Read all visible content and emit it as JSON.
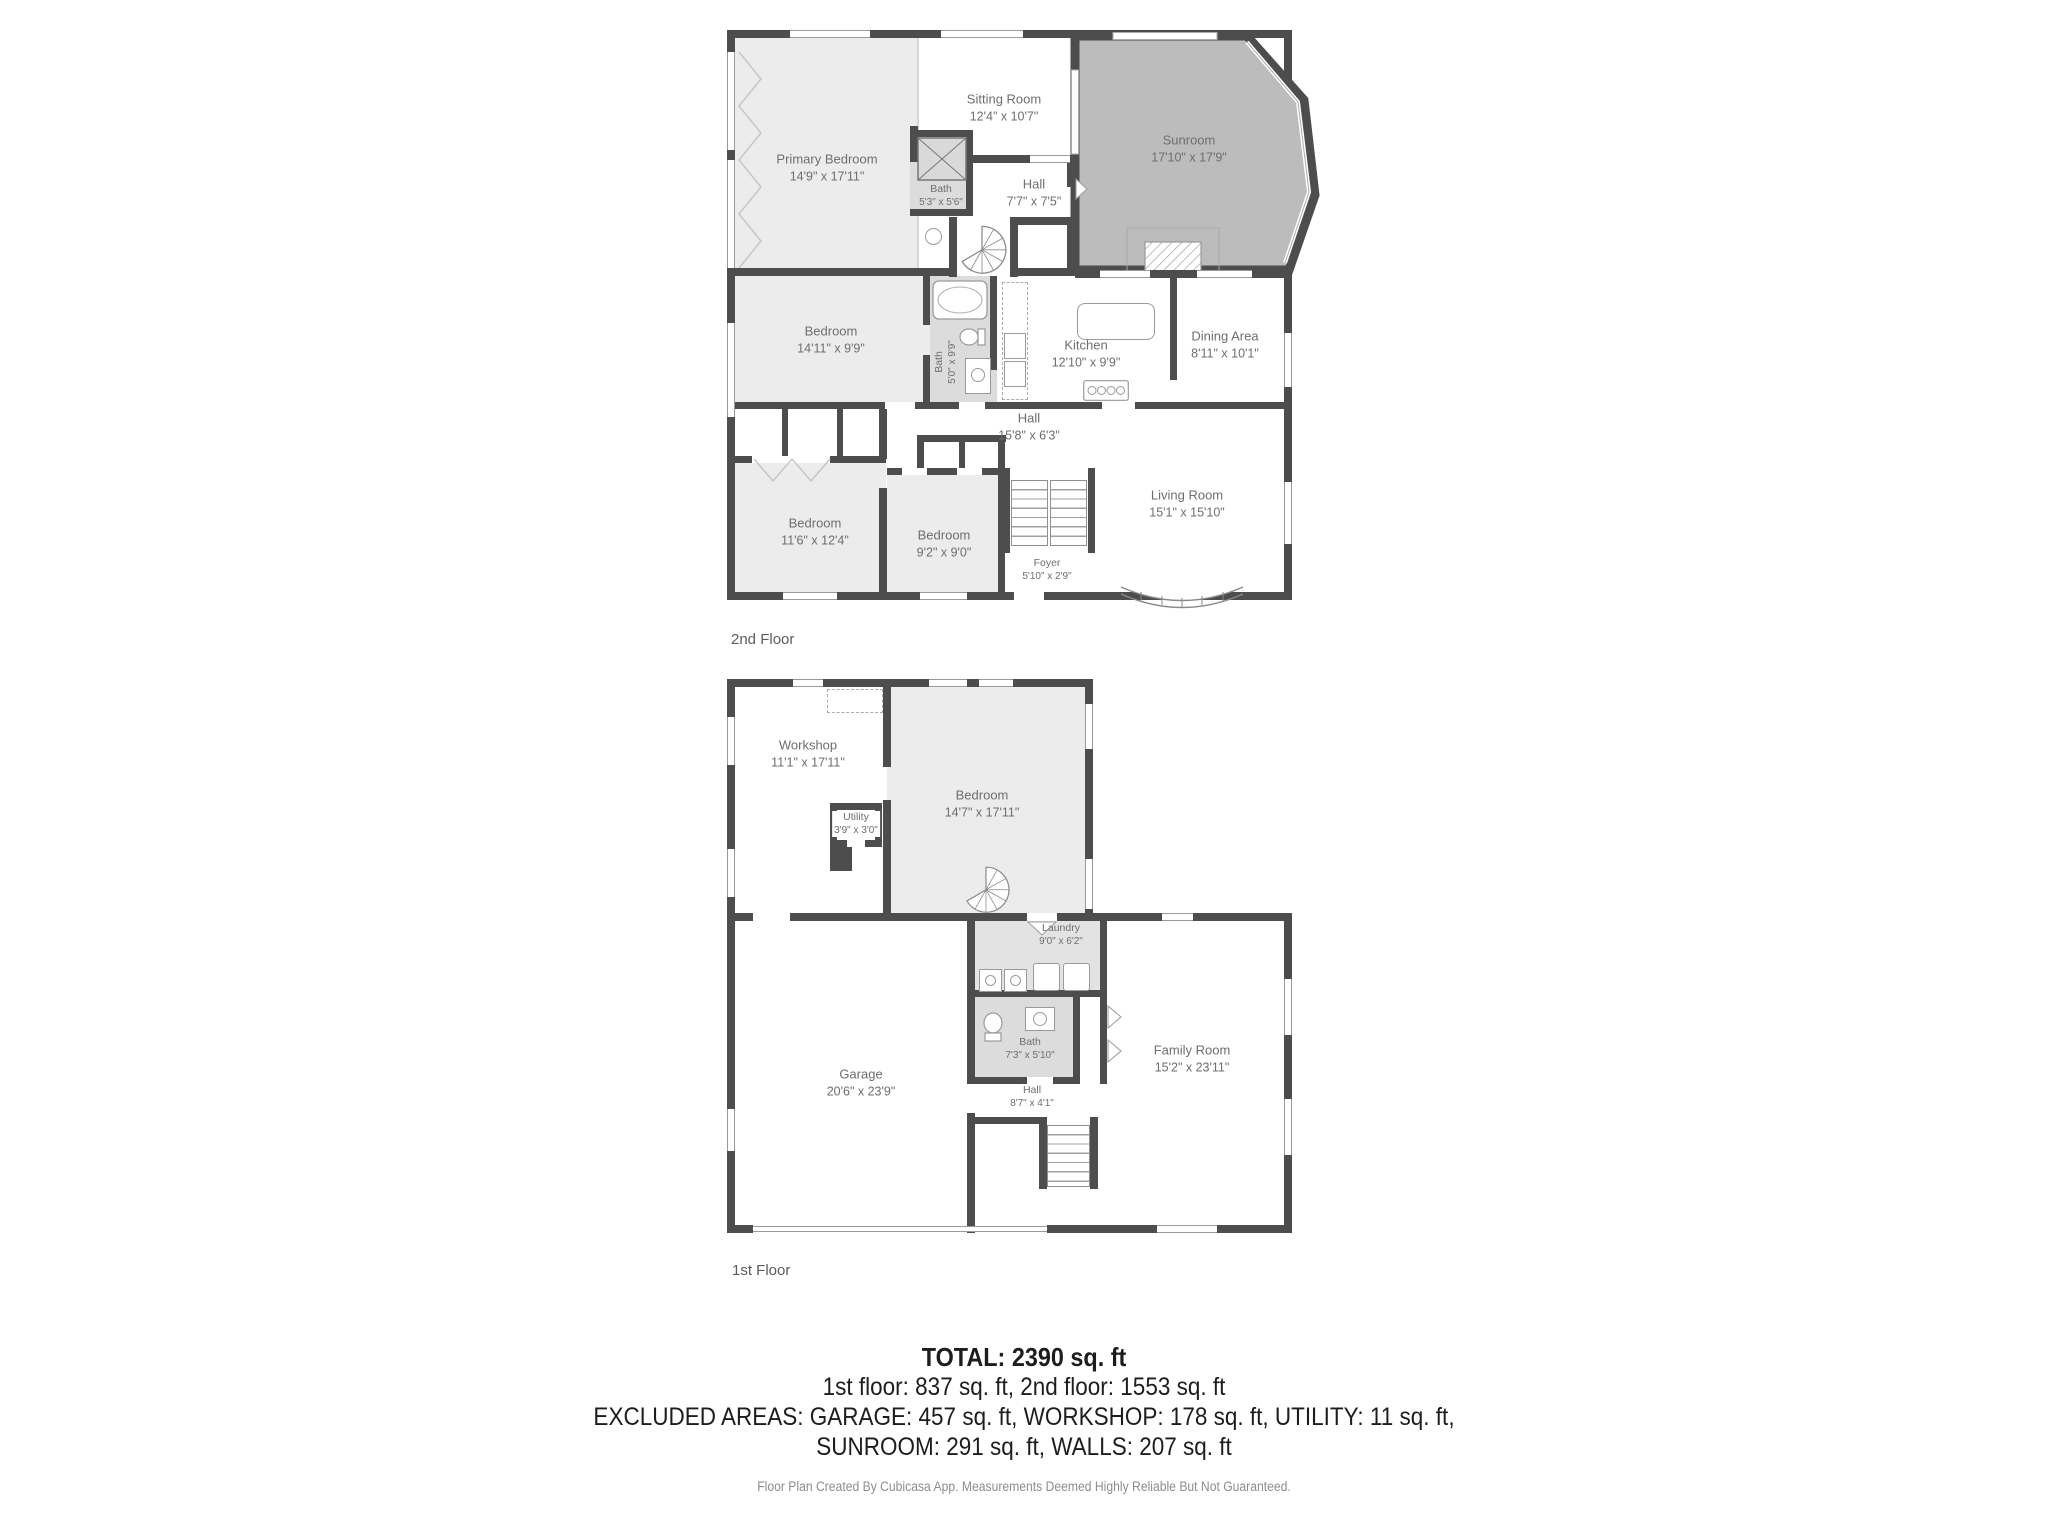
{
  "colors": {
    "wall": "#4d4d4d",
    "room_fill": "#ececec",
    "excluded_fill": "#bcbcbc",
    "bath_fill": "#dcdcdc",
    "label_text": "#6e6e6e"
  },
  "floor2": {
    "label": "2nd Floor",
    "rooms": {
      "primary_bedroom": {
        "name": "Primary Bedroom",
        "dims": "14'9\" x 17'11\""
      },
      "sitting_room": {
        "name": "Sitting Room",
        "dims": "12'4\" x 10'7\""
      },
      "sunroom": {
        "name": "Sunroom",
        "dims": "17'10\" x 17'9\""
      },
      "bath_small": {
        "name": "Bath",
        "dims": "5'3\" x 5'6\""
      },
      "hall_upper": {
        "name": "Hall",
        "dims": "7'7\" x 7'5\""
      },
      "bedroom_mid": {
        "name": "Bedroom",
        "dims": "14'11\" x 9'9\""
      },
      "bath_main": {
        "name": "Bath",
        "dims": "5'0\" x 9'9\""
      },
      "kitchen": {
        "name": "Kitchen",
        "dims": "12'10\" x 9'9\""
      },
      "dining": {
        "name": "Dining Area",
        "dims": "8'11\" x 10'1\""
      },
      "hall_main": {
        "name": "Hall",
        "dims": "15'8\" x 6'3\""
      },
      "bedroom_left": {
        "name": "Bedroom",
        "dims": "11'6\" x 12'4\""
      },
      "bedroom_small": {
        "name": "Bedroom",
        "dims": "9'2\" x 9'0\""
      },
      "foyer": {
        "name": "Foyer",
        "dims": "5'10\" x 2'9\""
      },
      "living": {
        "name": "Living Room",
        "dims": "15'1\" x 15'10\""
      }
    }
  },
  "floor1": {
    "label": "1st Floor",
    "rooms": {
      "workshop": {
        "name": "Workshop",
        "dims": "11'1\" x 17'11\""
      },
      "bedroom": {
        "name": "Bedroom",
        "dims": "14'7\" x 17'11\""
      },
      "utility": {
        "name": "Utility",
        "dims": "3'9\" x 3'0\""
      },
      "laundry": {
        "name": "Laundry",
        "dims": "9'0\" x 6'2\""
      },
      "garage": {
        "name": "Garage",
        "dims": "20'6\" x 23'9\""
      },
      "bath": {
        "name": "Bath",
        "dims": "7'3\" x 5'10\""
      },
      "hall": {
        "name": "Hall",
        "dims": "8'7\" x 4'1\""
      },
      "family_room": {
        "name": "Family Room",
        "dims": "15'2\" x 23'11\""
      }
    }
  },
  "summary": {
    "total": "TOTAL: 2390 sq. ft",
    "floors_line": "1st floor: 837 sq. ft, 2nd floor: 1553 sq. ft",
    "excluded_line1": "EXCLUDED AREAS: GARAGE: 457 sq. ft, WORKSHOP: 178 sq. ft, UTILITY: 11 sq. ft,",
    "excluded_line2": "SUNROOM: 291 sq. ft, WALLS: 207 sq. ft",
    "footer": "Floor Plan Created By Cubicasa App. Measurements Deemed Highly Reliable But Not Guaranteed."
  }
}
